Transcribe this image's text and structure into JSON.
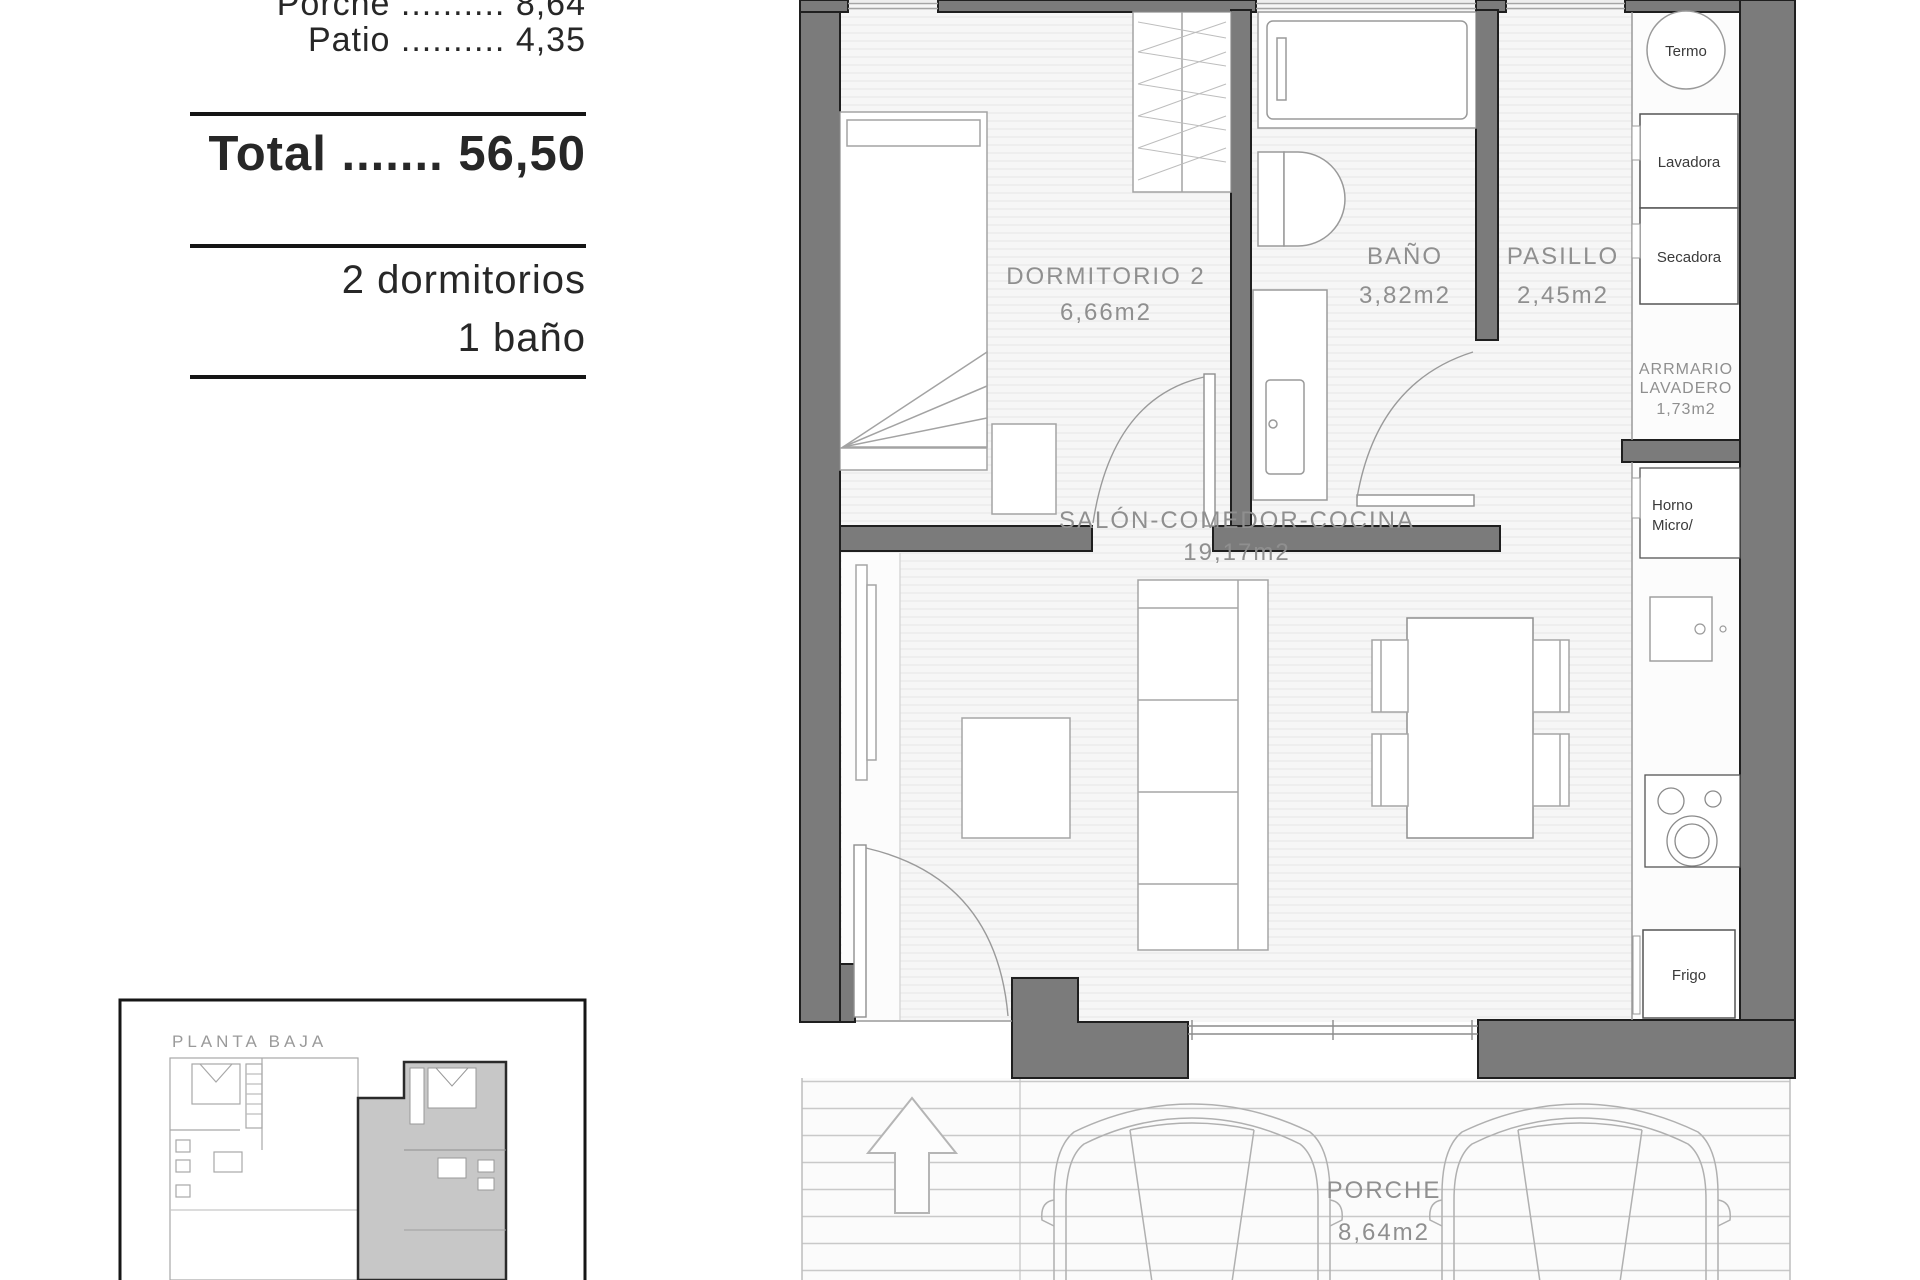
{
  "sidebar": {
    "lines": [
      "Porche .......... 8,64",
      "Patio .......... 4,35"
    ],
    "total": "Total ....... 56,50",
    "features": [
      "2 dormitorios",
      "1 baño"
    ]
  },
  "plan": {
    "rooms": {
      "dormitorio2": {
        "name": "DORMITORIO 2",
        "area": "6,66m2"
      },
      "bano": {
        "name": "BAÑO",
        "area": "3,82m2"
      },
      "pasillo": {
        "name": "PASILLO",
        "area": "2,45m2"
      },
      "salon": {
        "name": "SALÓN-COMEDOR-COCINA",
        "area": "19,17m2"
      },
      "armario_lavadero": {
        "name_line1": "ARRMARIO",
        "name_line2": "LAVADERO",
        "area": "1,73m2"
      },
      "porche": {
        "name": "PORCHE",
        "area": "8,64m2"
      }
    },
    "appliances": {
      "termo": "Termo",
      "lavadora": "Lavadora",
      "secadora": "Secadora",
      "horno_line1": "Horno",
      "horno_line2": "Micro/",
      "frigo": "Frigo"
    },
    "colors": {
      "wall": "#7b7b7b",
      "floor": "#f6f6f6",
      "label": "#8f8f8f",
      "porch_stripe": "#c9c9c9"
    }
  },
  "keyplan": {
    "title": "PLANTA BAJA"
  }
}
